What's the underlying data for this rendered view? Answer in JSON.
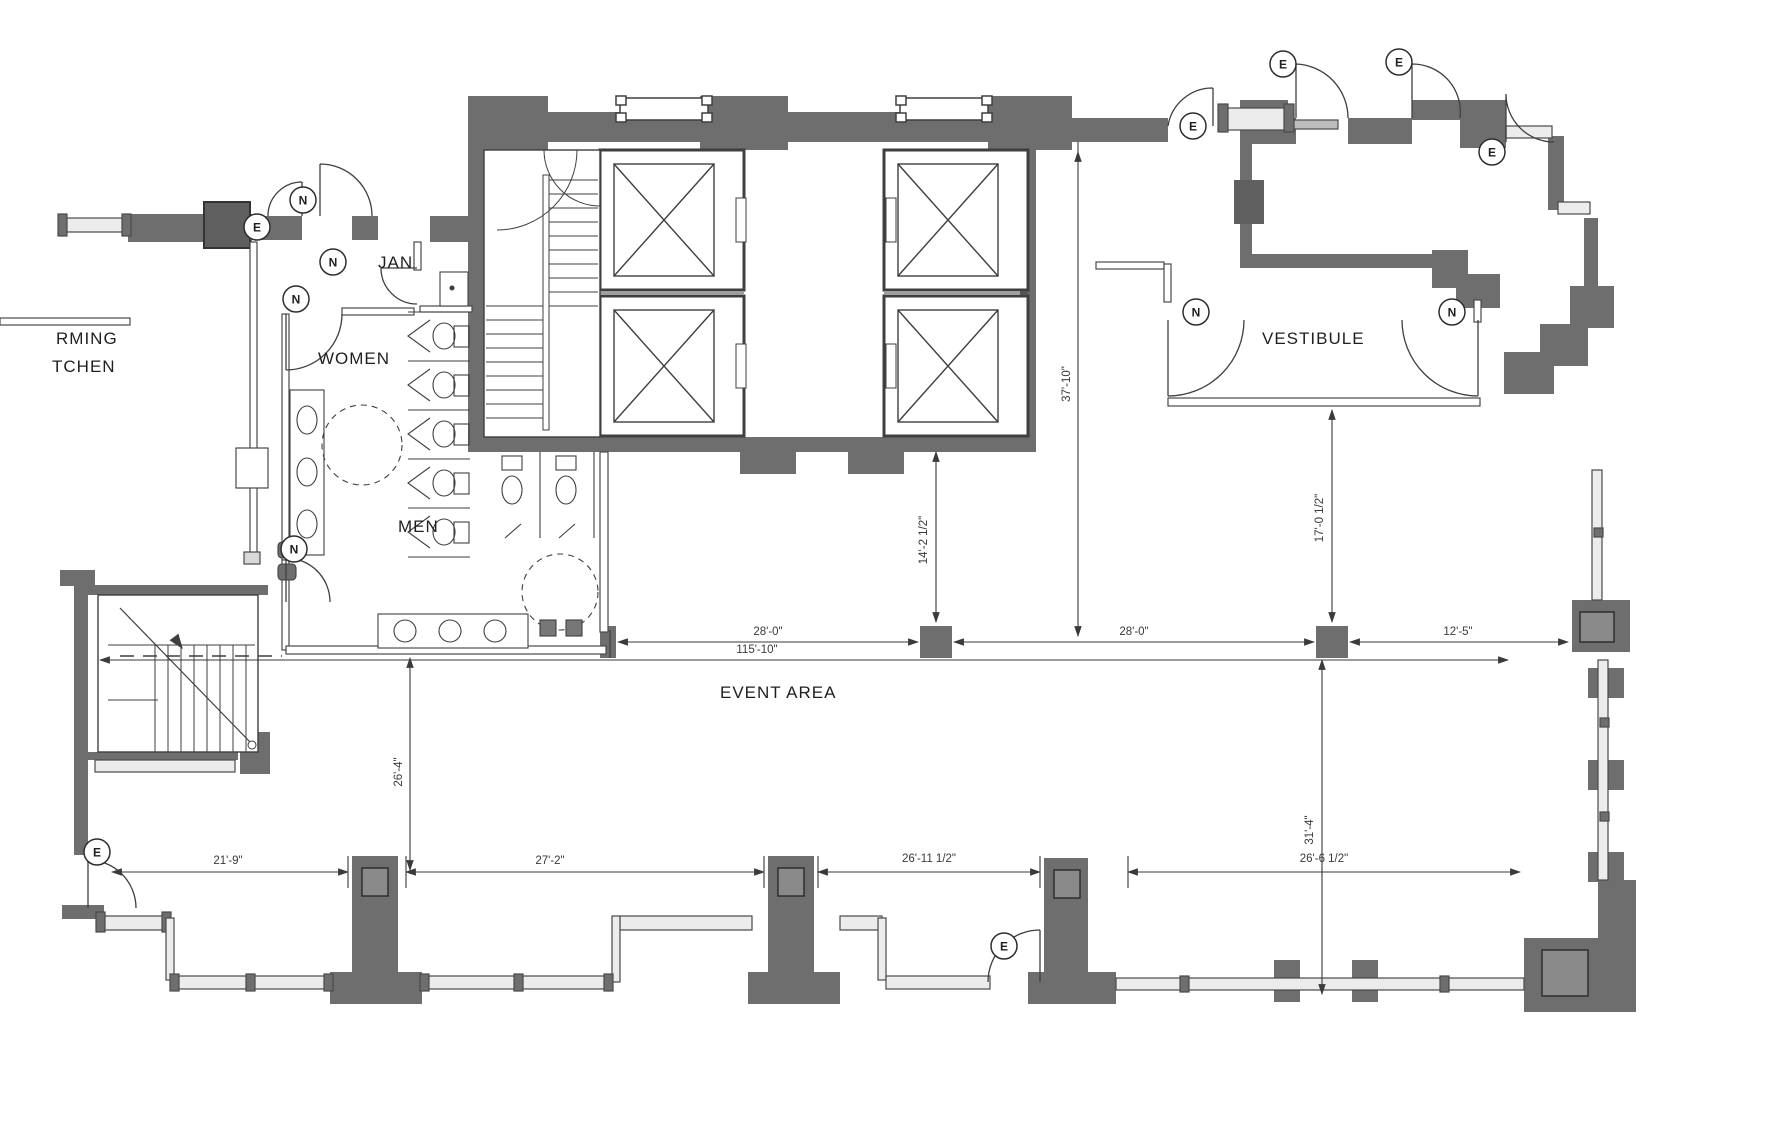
{
  "drawing": {
    "type": "architectural floor plan",
    "rooms": {
      "kitchen_line1": "RMING",
      "kitchen_line2": "TCHEN",
      "jan": "JAN",
      "women": "WOMEN",
      "men": "MEN",
      "vestibule": "VESTIBULE",
      "event_area": "EVENT AREA"
    },
    "dimensions": {
      "v37": "37'-10\"",
      "v14": "14'-2 1/2\"",
      "v17": "17'-0 1/2\"",
      "h28a": "28'-0\"",
      "h28b": "28'-0\"",
      "h12": "12'-5\"",
      "h115": "115'-10\"",
      "v26": "26'-4\"",
      "v31": "31'-4\"",
      "b21": "21'-9\"",
      "b27": "27'-2\"",
      "b26a": "26'-11 1/2\"",
      "b26b": "26'-6 1/2\""
    },
    "door_tags": {
      "e": "E",
      "n": "N"
    },
    "colors": {
      "wall": "#6e6e6e",
      "wall_dark": "#575757",
      "line": "#3f3f3f",
      "dim_line": "#4a4a4a",
      "window_fill": "#ececec",
      "inner_column": "#8a8a8a"
    }
  }
}
